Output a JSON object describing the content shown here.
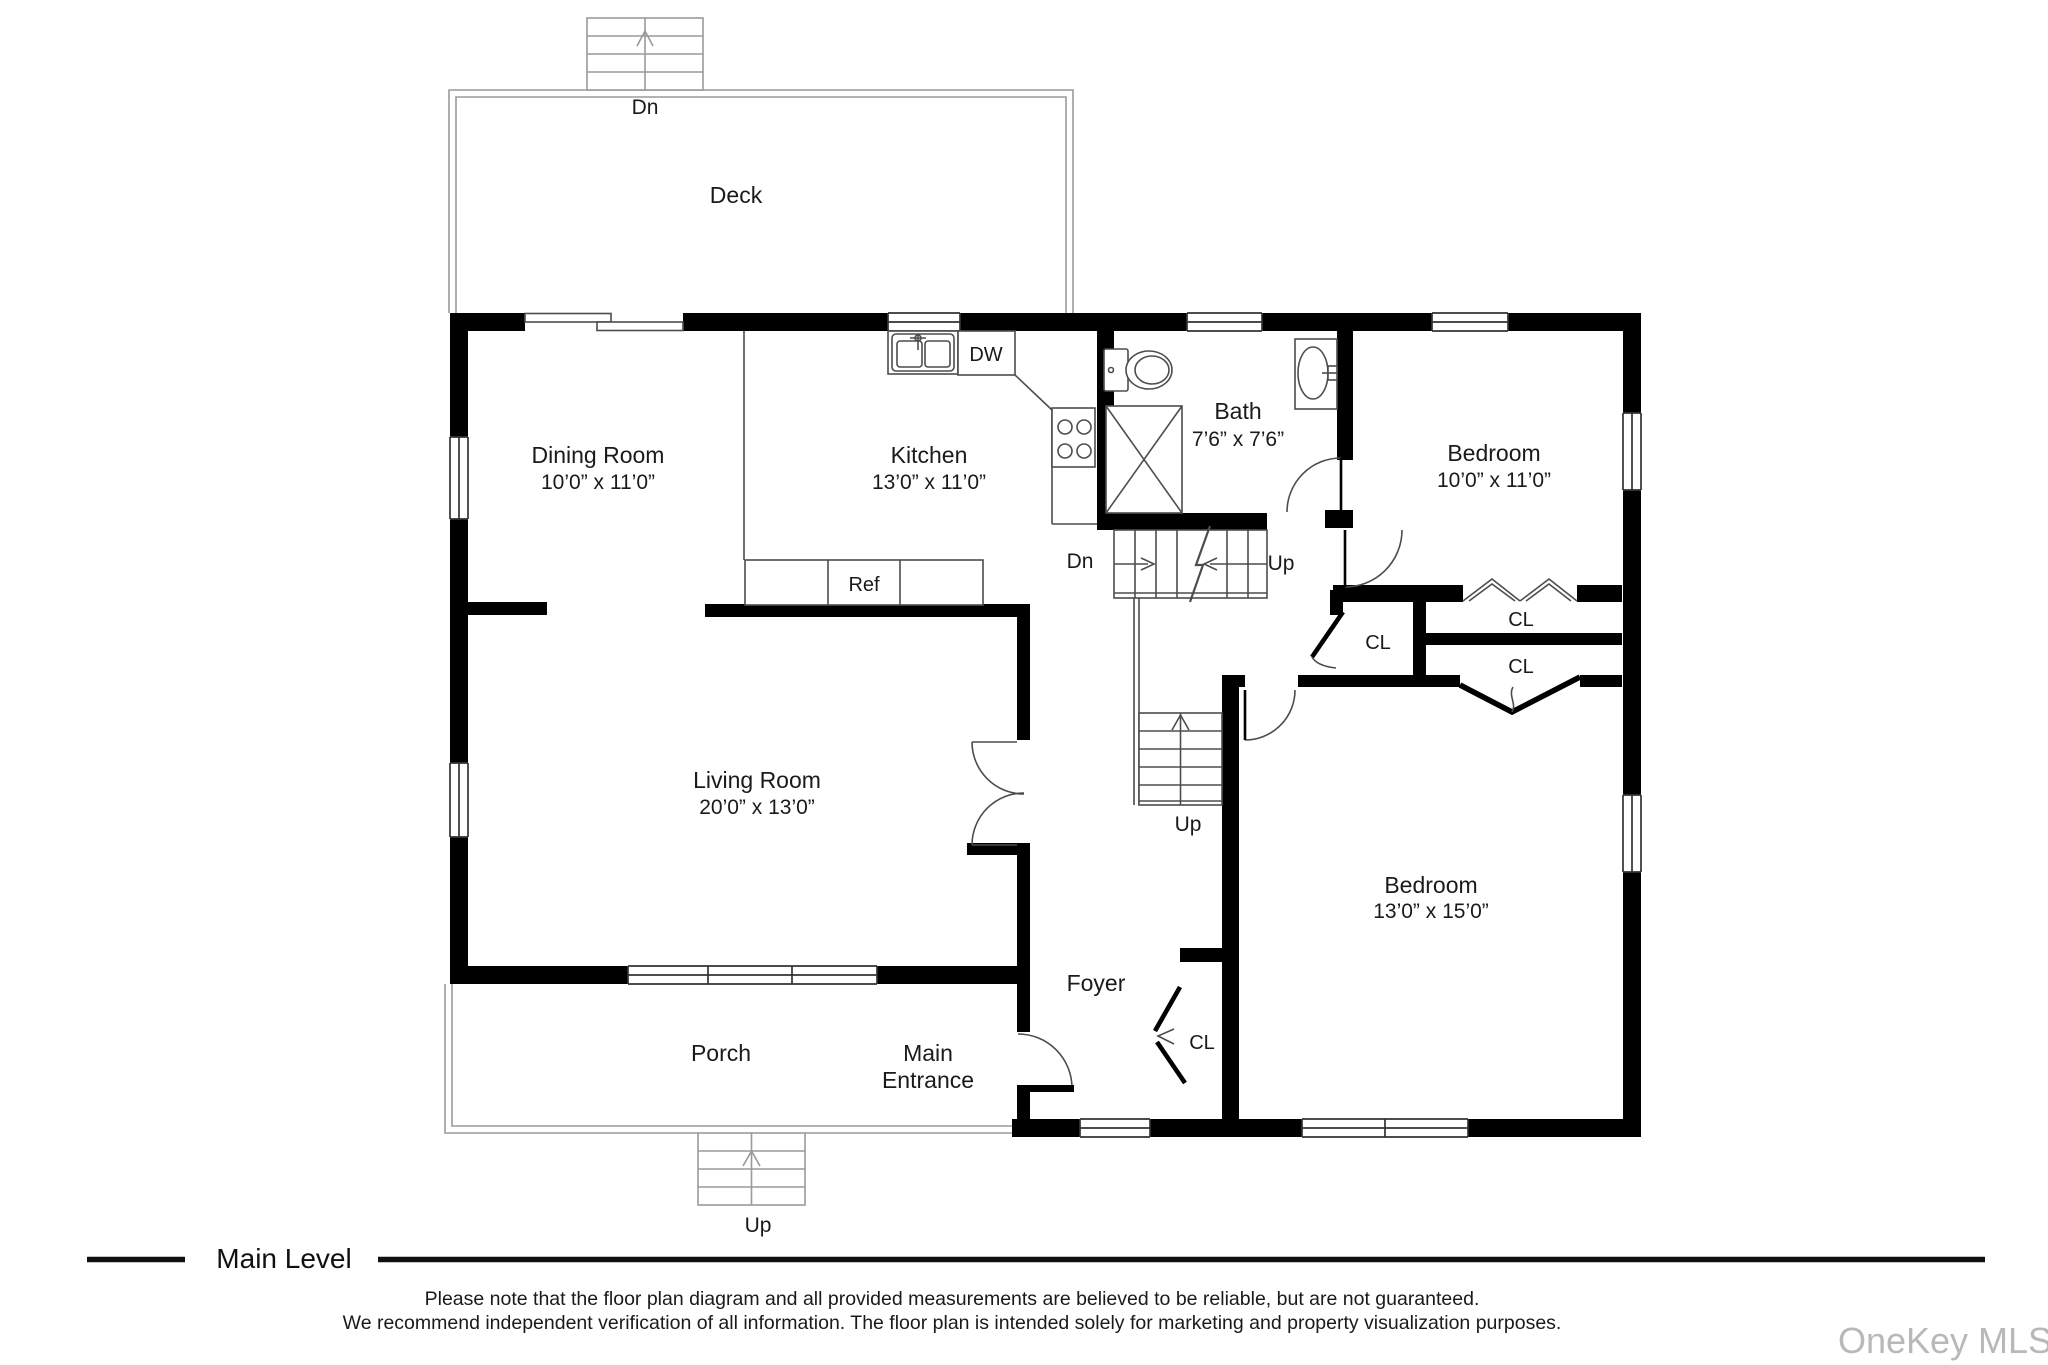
{
  "rooms": {
    "deck": {
      "label": "Deck"
    },
    "dining": {
      "label": "Dining Room",
      "dims": "10’0” x 11’0”"
    },
    "kitchen": {
      "label": "Kitchen",
      "dims": "13’0” x 11’0”"
    },
    "bath": {
      "label": "Bath",
      "dims": "7’6” x 7’6”"
    },
    "bedroom1": {
      "label": "Bedroom",
      "dims": "10’0” x 11’0”"
    },
    "living": {
      "label": "Living Room",
      "dims": "20’0” x 13’0”"
    },
    "bedroom2": {
      "label": "Bedroom",
      "dims": "13’0” x 15’0”"
    },
    "foyer": {
      "label": "Foyer"
    },
    "porch": {
      "label": "Porch"
    },
    "entrance": {
      "lines": [
        "Main",
        "Entrance"
      ]
    }
  },
  "stairs": {
    "deck_down": "Dn",
    "main_down": "Dn",
    "main_up": "Up",
    "hall_up": "Up",
    "porch_up": "Up"
  },
  "fixtures": {
    "dishwasher": "DW",
    "refrigerator": "Ref"
  },
  "closets": {
    "hall": "CL",
    "upper": "CL",
    "lower": "CL",
    "foyer": "CL"
  },
  "footer": {
    "level": "Main Level",
    "disclaimer1": "Please note that the floor plan diagram and all provided measurements are believed to be reliable, but are not guaranteed.",
    "disclaimer2": "We recommend independent verification of all information. The floor plan is intended solely for marketing and property visualization purposes."
  },
  "watermark": "OneKey MLS",
  "colors": {
    "wall": "#000000",
    "thin_line": "#4d4d4d",
    "outdoor_line": "#9a9a9a",
    "watermark": "#b8b8b8"
  }
}
